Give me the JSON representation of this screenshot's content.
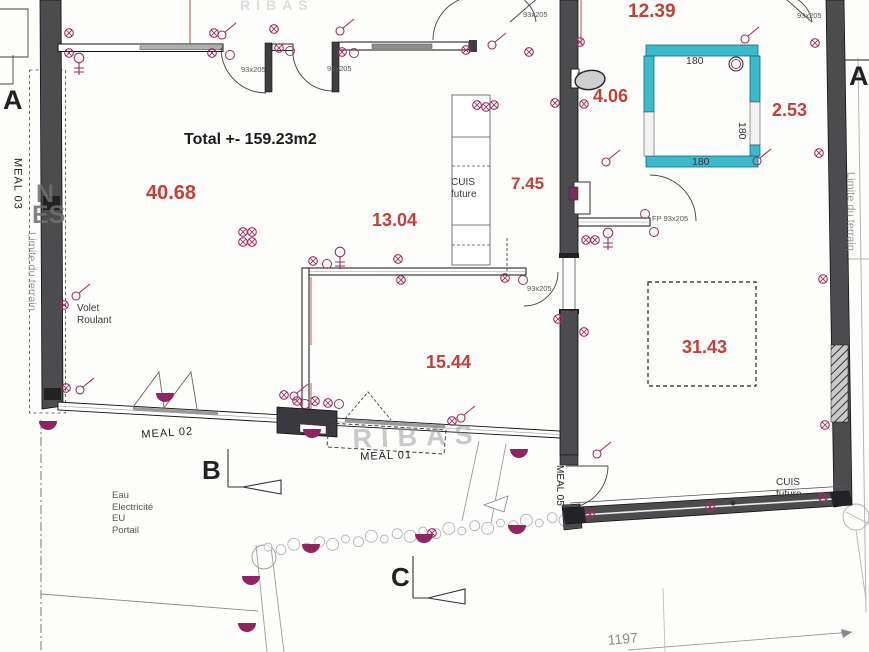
{
  "colors": {
    "wall": "#4c4c4f",
    "accent_red": "#c0403a",
    "symbol": "#9b2f63",
    "spot": "#8e2460",
    "shower": "#3cb9cb"
  },
  "labels": [
    {
      "n": "total-area-label",
      "t": "Total +- 159.23m2",
      "x": 184,
      "y": 130,
      "fs": 16,
      "c": "#1c1c1c",
      "b": 1
    },
    {
      "n": "room-area-label",
      "t": "40.68",
      "x": 146,
      "y": 181,
      "fs": 20,
      "c": "#c0403a",
      "b": 1
    },
    {
      "n": "room-area-label",
      "t": "13.04",
      "x": 372,
      "y": 210,
      "fs": 18,
      "c": "#c0403a",
      "b": 1
    },
    {
      "n": "room-area-label",
      "t": "15.44",
      "x": 426,
      "y": 352,
      "fs": 18,
      "c": "#c0403a",
      "b": 1
    },
    {
      "n": "room-area-label",
      "t": "7.45",
      "x": 511,
      "y": 174,
      "fs": 17,
      "c": "#c0403a",
      "b": 1
    },
    {
      "n": "room-area-label",
      "t": "12.39",
      "x": 628,
      "y": 0,
      "fs": 19,
      "c": "#c0403a",
      "b": 1
    },
    {
      "n": "room-area-label",
      "t": "4.06",
      "x": 593,
      "y": 86,
      "fs": 18,
      "c": "#c0403a",
      "b": 1
    },
    {
      "n": "room-area-label",
      "t": "2.53",
      "x": 772,
      "y": 100,
      "fs": 18,
      "c": "#c0403a",
      "b": 1
    },
    {
      "n": "room-area-label",
      "t": "31.43",
      "x": 682,
      "y": 337,
      "fs": 18,
      "c": "#c0403a",
      "b": 1
    },
    {
      "n": "cuis-future-label",
      "t": "CUIS\nfuture",
      "x": 451,
      "y": 177,
      "fs": 10,
      "c": "#3a3a3a"
    },
    {
      "n": "cuis-future-label",
      "t": "CUIS\nfuture",
      "x": 776,
      "y": 477,
      "fs": 10,
      "c": "#3a3a3a"
    },
    {
      "n": "meal-01-label",
      "t": "MEAL 01",
      "x": 360,
      "y": 451,
      "fs": 11,
      "c": "#222",
      "rot": -2,
      "ls": 1
    },
    {
      "n": "meal-02-label",
      "t": "MEAL 02",
      "x": 141,
      "y": 429,
      "fs": 11,
      "c": "#222",
      "rot": -4,
      "ls": 1
    },
    {
      "n": "meal-03-label",
      "t": "MEAL 03",
      "x": 10,
      "y": 158,
      "fs": 11,
      "c": "#222",
      "vert": 1,
      "ls": 1
    },
    {
      "n": "meal-05-label",
      "t": "MEAL 05",
      "x": 553,
      "y": 465,
      "fs": 10,
      "c": "#222",
      "vert": 1
    },
    {
      "n": "volet-roulant-label",
      "t": "Volet\nRoulant",
      "x": 77,
      "y": 303,
      "fs": 10,
      "c": "#3a3a3a"
    },
    {
      "n": "utilities-label",
      "t": "Eau\nElectricité\nEU\nPortail",
      "x": 112,
      "y": 490,
      "fs": 9.5,
      "c": "#555"
    },
    {
      "n": "door-size-label",
      "t": "93x205",
      "x": 241,
      "y": 65,
      "fs": 7.5,
      "c": "#555"
    },
    {
      "n": "door-size-label",
      "t": "93x205",
      "x": 327,
      "y": 64,
      "fs": 7.5,
      "c": "#555"
    },
    {
      "n": "door-size-label",
      "t": "93x205",
      "x": 523,
      "y": 10,
      "fs": 7.5,
      "c": "#555"
    },
    {
      "n": "door-size-label",
      "t": "93x205",
      "x": 527,
      "y": 284,
      "fs": 7.5,
      "c": "#555"
    },
    {
      "n": "door-size-label",
      "t": "93x205",
      "x": 797,
      "y": 11,
      "fs": 7.5,
      "c": "#555"
    },
    {
      "n": "door-size-label",
      "t": "FP 93x205",
      "x": 652,
      "y": 214,
      "fs": 7.5,
      "c": "#555"
    },
    {
      "n": "shower-dim-label",
      "t": "180",
      "x": 686,
      "y": 55,
      "fs": 10.5,
      "c": "#333"
    },
    {
      "n": "shower-dim-label",
      "t": "180",
      "x": 692,
      "y": 156,
      "fs": 10.5,
      "c": "#333"
    },
    {
      "n": "shower-dim-label",
      "t": "180",
      "x": 748,
      "y": 122,
      "fs": 10.5,
      "c": "#333",
      "rot": 90
    },
    {
      "n": "parcel-dim-label",
      "t": "1197",
      "x": 607,
      "y": 632,
      "fs": 14,
      "c": "#8a8a8a",
      "rot": -5
    },
    {
      "n": "section-letter",
      "t": "A",
      "x": 3,
      "y": 84,
      "fs": 27,
      "c": "#222",
      "b": 1
    },
    {
      "n": "section-letter",
      "t": "A",
      "x": 849,
      "y": 60,
      "fs": 27,
      "c": "#222",
      "b": 1
    },
    {
      "n": "section-letter",
      "t": "B",
      "x": 202,
      "y": 455,
      "fs": 26,
      "c": "#222",
      "b": 1
    },
    {
      "n": "section-letter",
      "t": "C",
      "x": 391,
      "y": 562,
      "fs": 26,
      "c": "#222",
      "b": 1
    },
    {
      "n": "limite-terrain-label",
      "t": "Limite du terrain",
      "x": 843,
      "y": 172,
      "fs": 11,
      "c": "#9a9a9a",
      "vert": 1
    },
    {
      "n": "limite-terrain-label",
      "t": "Limite du terrain",
      "x": 24,
      "y": 232,
      "fs": 11,
      "c": "#9a9a9a",
      "vert": 1,
      "mh": 118
    },
    {
      "n": "watermark",
      "t": "RIBAS",
      "x": 352,
      "y": 423,
      "fs": 27,
      "c": "rgba(150,150,150,0.5)",
      "ls": 9,
      "b": 1,
      "rot": -2
    },
    {
      "n": "watermark",
      "t": "RIBAS",
      "x": 240,
      "y": -3,
      "fs": 14,
      "c": "rgba(195,195,195,0.55)",
      "ls": 6,
      "b": 1
    },
    {
      "n": "watermark",
      "t": "N",
      "x": 36,
      "y": 179,
      "fs": 25,
      "c": "rgba(110,110,110,0.85)",
      "b": 1
    },
    {
      "n": "watermark",
      "t": "ES",
      "x": 32,
      "y": 200,
      "fs": 25,
      "c": "rgba(110,110,110,0.85)",
      "b": 1
    }
  ],
  "symbols": [
    {
      "t": "o",
      "x": 69,
      "y": 33
    },
    {
      "t": "o",
      "x": 69,
      "y": 53
    },
    {
      "t": "o",
      "x": 214,
      "y": 33
    },
    {
      "t": "o",
      "x": 212,
      "y": 53
    },
    {
      "t": "o",
      "x": 279,
      "y": 48
    },
    {
      "t": "o",
      "x": 274,
      "y": 29
    },
    {
      "t": "o",
      "x": 342,
      "y": 52
    },
    {
      "t": "o",
      "x": 466,
      "y": 50
    },
    {
      "t": "o",
      "x": 529,
      "y": 52
    },
    {
      "t": "o",
      "x": 555,
      "y": 103
    },
    {
      "t": "o",
      "x": 584,
      "y": 104
    },
    {
      "t": "o",
      "x": 477,
      "y": 105
    },
    {
      "t": "o",
      "x": 486,
      "y": 107
    },
    {
      "t": "o",
      "x": 494,
      "y": 105
    },
    {
      "t": "o",
      "x": 580,
      "y": 42
    },
    {
      "t": "o",
      "x": 815,
      "y": 43
    },
    {
      "t": "o",
      "x": 819,
      "y": 153
    },
    {
      "t": "o",
      "x": 823,
      "y": 279
    },
    {
      "t": "o",
      "x": 586,
      "y": 240
    },
    {
      "t": "o",
      "x": 595,
      "y": 240
    },
    {
      "t": "o",
      "x": 584,
      "y": 332
    },
    {
      "t": "o",
      "x": 64,
      "y": 305
    },
    {
      "t": "o",
      "x": 66,
      "y": 388
    },
    {
      "t": "o",
      "x": 243,
      "y": 232
    },
    {
      "t": "o",
      "x": 252,
      "y": 232
    },
    {
      "t": "o",
      "x": 243,
      "y": 242
    },
    {
      "t": "o",
      "x": 252,
      "y": 242
    },
    {
      "t": "o",
      "x": 313,
      "y": 261
    },
    {
      "t": "o",
      "x": 398,
      "y": 259
    },
    {
      "t": "o",
      "x": 401,
      "y": 280
    },
    {
      "t": "o",
      "x": 505,
      "y": 278
    },
    {
      "t": "o",
      "x": 558,
      "y": 319
    },
    {
      "t": "o",
      "x": 315,
      "y": 401
    },
    {
      "t": "o",
      "x": 328,
      "y": 403
    },
    {
      "t": "o",
      "x": 284,
      "y": 395
    },
    {
      "t": "o",
      "x": 297,
      "y": 401
    },
    {
      "t": "o",
      "x": 452,
      "y": 421
    },
    {
      "t": "o",
      "x": 432,
      "y": 533
    },
    {
      "t": "o",
      "x": 590,
      "y": 514
    },
    {
      "t": "o",
      "x": 710,
      "y": 507
    },
    {
      "t": "o",
      "x": 823,
      "y": 497
    },
    {
      "t": "o",
      "x": 825,
      "y": 425
    },
    {
      "t": "s",
      "x": 222,
      "y": 35
    },
    {
      "t": "s",
      "x": 340,
      "y": 31
    },
    {
      "t": "s",
      "x": 492,
      "y": 45
    },
    {
      "t": "s",
      "x": 745,
      "y": 39
    },
    {
      "t": "s",
      "x": 76,
      "y": 296
    },
    {
      "t": "s",
      "x": 80,
      "y": 390
    },
    {
      "t": "s",
      "x": 294,
      "y": 396
    },
    {
      "t": "s",
      "x": 606,
      "y": 162
    },
    {
      "t": "s",
      "x": 597,
      "y": 454
    },
    {
      "t": "s",
      "x": 757,
      "y": 161
    },
    {
      "t": "s",
      "x": 461,
      "y": 418
    },
    {
      "t": "k",
      "x": 230,
      "y": 55
    },
    {
      "t": "k",
      "x": 290,
      "y": 51
    },
    {
      "t": "k",
      "x": 354,
      "y": 53
    },
    {
      "t": "k",
      "x": 523,
      "y": 280
    },
    {
      "t": "k",
      "x": 327,
      "y": 264
    },
    {
      "t": "k",
      "x": 339,
      "y": 404
    },
    {
      "t": "k",
      "x": 645,
      "y": 214
    },
    {
      "t": "k",
      "x": 654,
      "y": 232
    },
    {
      "t": "k",
      "x": 736,
      "y": 64
    },
    {
      "t": "k",
      "x": 305,
      "y": 404
    },
    {
      "t": "l",
      "x": 79,
      "y": 58
    },
    {
      "t": "l",
      "x": 340,
      "y": 252
    },
    {
      "t": "l",
      "x": 608,
      "y": 233
    },
    {
      "t": "p",
      "x": 48,
      "y": 421
    },
    {
      "t": "p",
      "x": 165,
      "y": 393
    },
    {
      "t": "p",
      "x": 312,
      "y": 429
    },
    {
      "t": "p",
      "x": 519,
      "y": 449
    },
    {
      "t": "p",
      "x": 311,
      "y": 544
    },
    {
      "t": "p",
      "x": 424,
      "y": 534
    },
    {
      "t": "p",
      "x": 517,
      "y": 525
    },
    {
      "t": "p",
      "x": 251,
      "y": 576
    },
    {
      "t": "p",
      "x": 247,
      "y": 623
    },
    {
      "t": "d",
      "x": 733,
      "y": 503
    }
  ],
  "hedge": {
    "x1": 268,
    "y1": 549,
    "x2": 578,
    "y2": 517,
    "count": 25
  }
}
